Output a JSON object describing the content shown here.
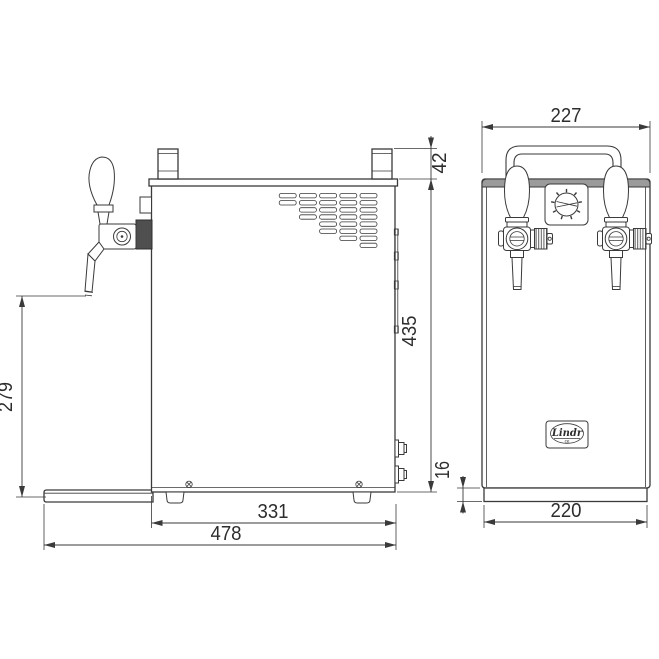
{
  "page": {
    "background": "#ffffff"
  },
  "drawing": {
    "colors": {
      "line": "#3a3a3a",
      "knurl_fill": "#4f4f4f",
      "top_band": "#9b9b9b"
    },
    "side_view": {
      "dimensions": {
        "post_height": "42",
        "body_height": "435",
        "tap_outlet_height": "279",
        "body_width": "331",
        "total_width": "478"
      }
    },
    "front_view": {
      "dimensions": {
        "overall_width": "227",
        "base_width": "220",
        "base_height": "16"
      },
      "logo": {
        "script": "Lindr",
        "mark": "ce"
      }
    }
  }
}
